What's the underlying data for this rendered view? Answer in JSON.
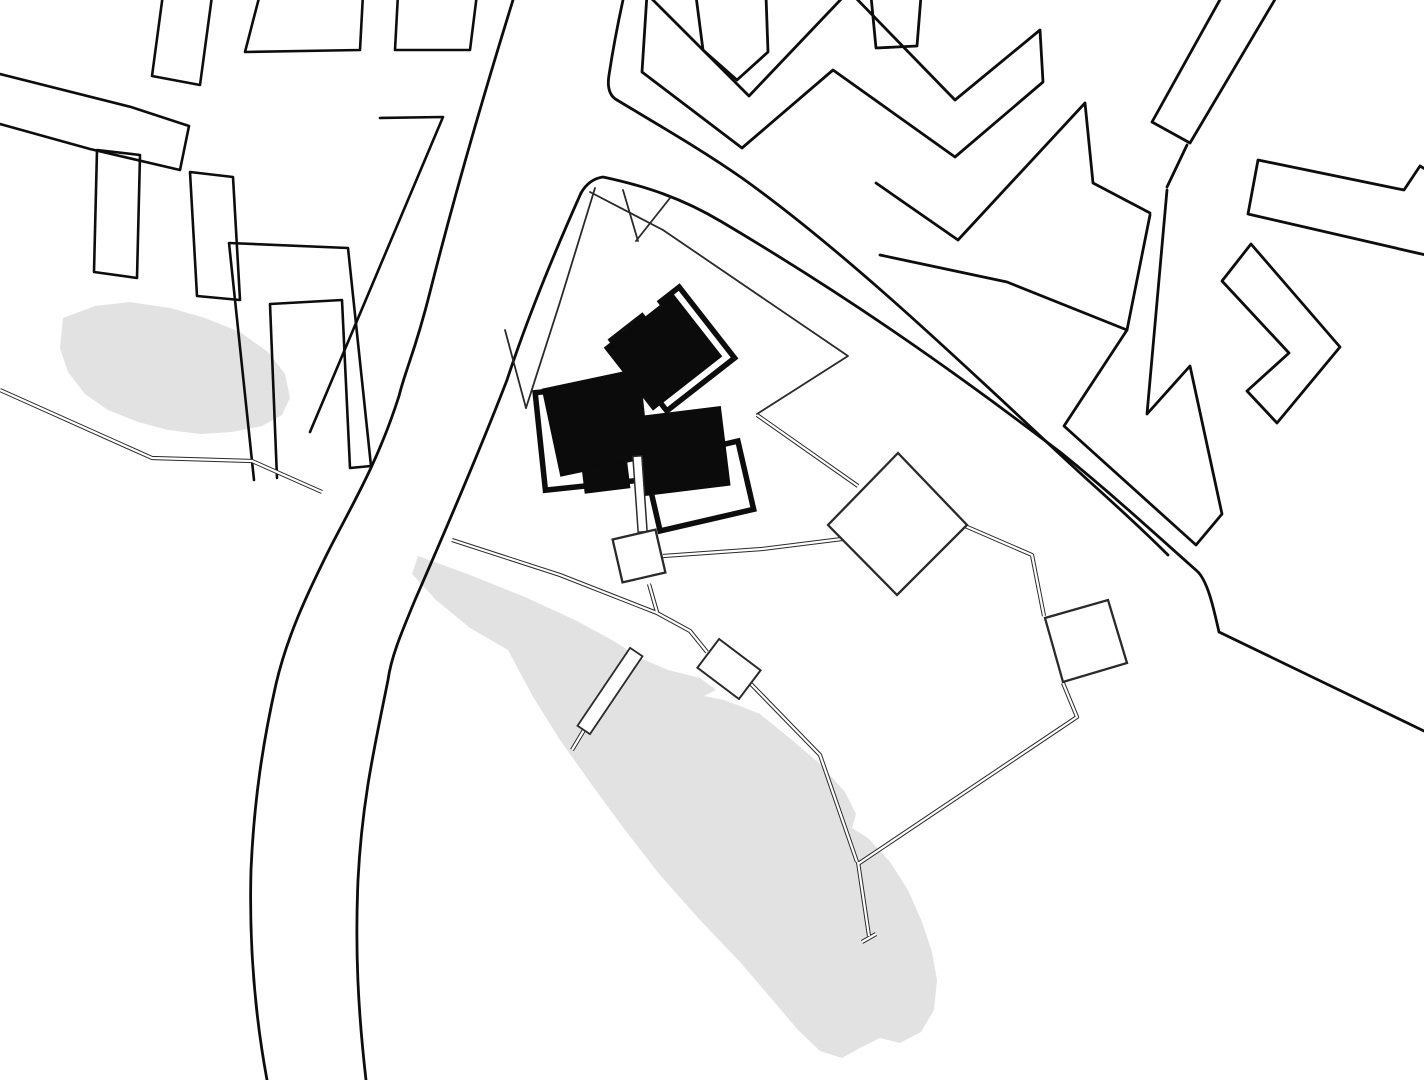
{
  "document": {
    "kind": "architectural-site-plan",
    "title": "",
    "visible_text": []
  },
  "palette": {
    "background": "#ffffff",
    "line": "#0d0d0d",
    "thin_line": "#2a2a2a",
    "water_gray": "#e2e2e2",
    "building_black": "#0b0b0b",
    "white": "#ffffff"
  },
  "features": {
    "water_bodies": [
      {
        "name": "pond-northwest",
        "shade": "#e2e2e2"
      },
      {
        "name": "lake-central-diagonal",
        "shade": "#e2e2e2"
      }
    ],
    "roads": [
      {
        "name": "curved-road-west",
        "edges": 2
      },
      {
        "name": "diagonal-avenue-east",
        "edges": 2
      }
    ],
    "site": {
      "name": "project-site",
      "building": {
        "name": "pinwheel-building-cluster",
        "black_volumes": 3,
        "white_plinths": 3
      },
      "pavilions": 4,
      "footpaths": "thin double-line network",
      "bridge": "narrow footbridge across lake"
    },
    "context_blocks": {
      "northwest_housing_blocks": 7,
      "northeast_zigzag_blocks": 6,
      "east_edge_blocks": 3
    }
  }
}
